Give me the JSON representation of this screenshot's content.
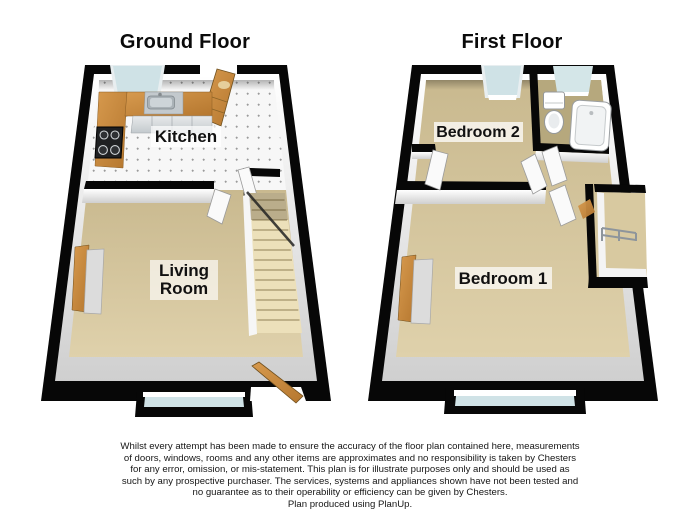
{
  "ground_floor": {
    "title": "Ground Floor",
    "kitchen_label": "Kitchen",
    "living_room_label_line1": "Living",
    "living_room_label_line2": "Room"
  },
  "first_floor": {
    "title": "First Floor",
    "bedroom2_label": "Bedroom 2",
    "bedroom1_label": "Bedroom 1"
  },
  "disclaimer": {
    "body": "Whilst every attempt has been made to ensure the accuracy of the floor plan contained here, measurements of doors, windows, rooms and any other items are approximates and no responsibility is taken by Chesters for any error, omission, or mis-statement. This plan is for illustrate purposes only and should be used as such by any prospective purchaser. The services, systems and appliances shown have not been tested and no guarantee as to their operability or efficiency can be given by Chesters.",
    "produced_line": "Plan produced using PlanUp."
  },
  "colors": {
    "wall": "#000000",
    "carpet": "#d5c59d",
    "kitchen_tile": "#f7f7f7",
    "bathroom_floor": "#b6a87d",
    "wood": "#c9893c",
    "window_glass": "#cfe2e6",
    "stairs": "#ece0ba",
    "fixture_white": "#ffffff",
    "label_background": "#f2f2f2"
  }
}
